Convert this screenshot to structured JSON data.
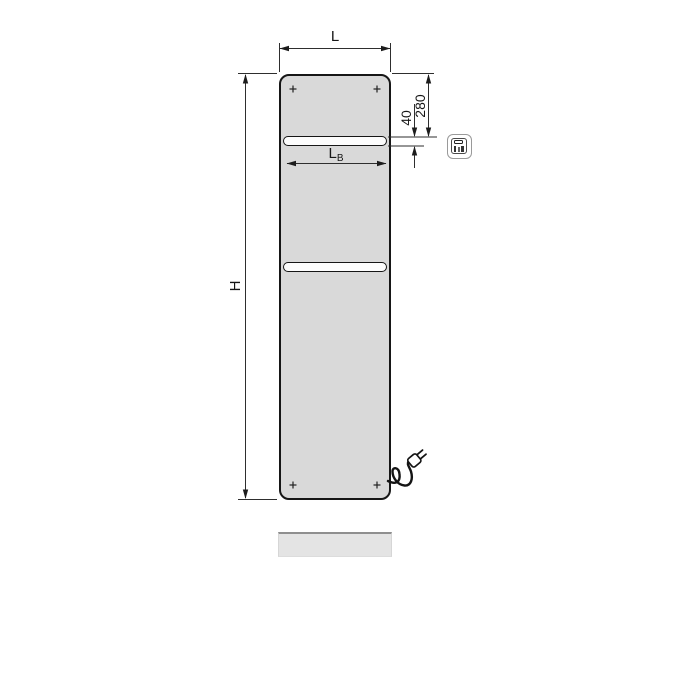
{
  "dimensions": {
    "width_label": "L",
    "height_label": "H",
    "top_to_bar_label": "280",
    "bar_thickness_label": "40",
    "bar_length_label": "L",
    "bar_length_subscript": "B"
  },
  "icons": {
    "electric_badge": "electric-plug-icon"
  },
  "colors": {
    "background": "#ffffff",
    "panel_fill": "#d9d9d9",
    "bar_fill": "#fcfcfc",
    "outline": "#161616",
    "dimension_line": "#2e2e2e",
    "baseboard_fill": "#e4e4e4",
    "baseboard_edge": "#8f8f8f",
    "icon_border": "#9a9a9a"
  }
}
